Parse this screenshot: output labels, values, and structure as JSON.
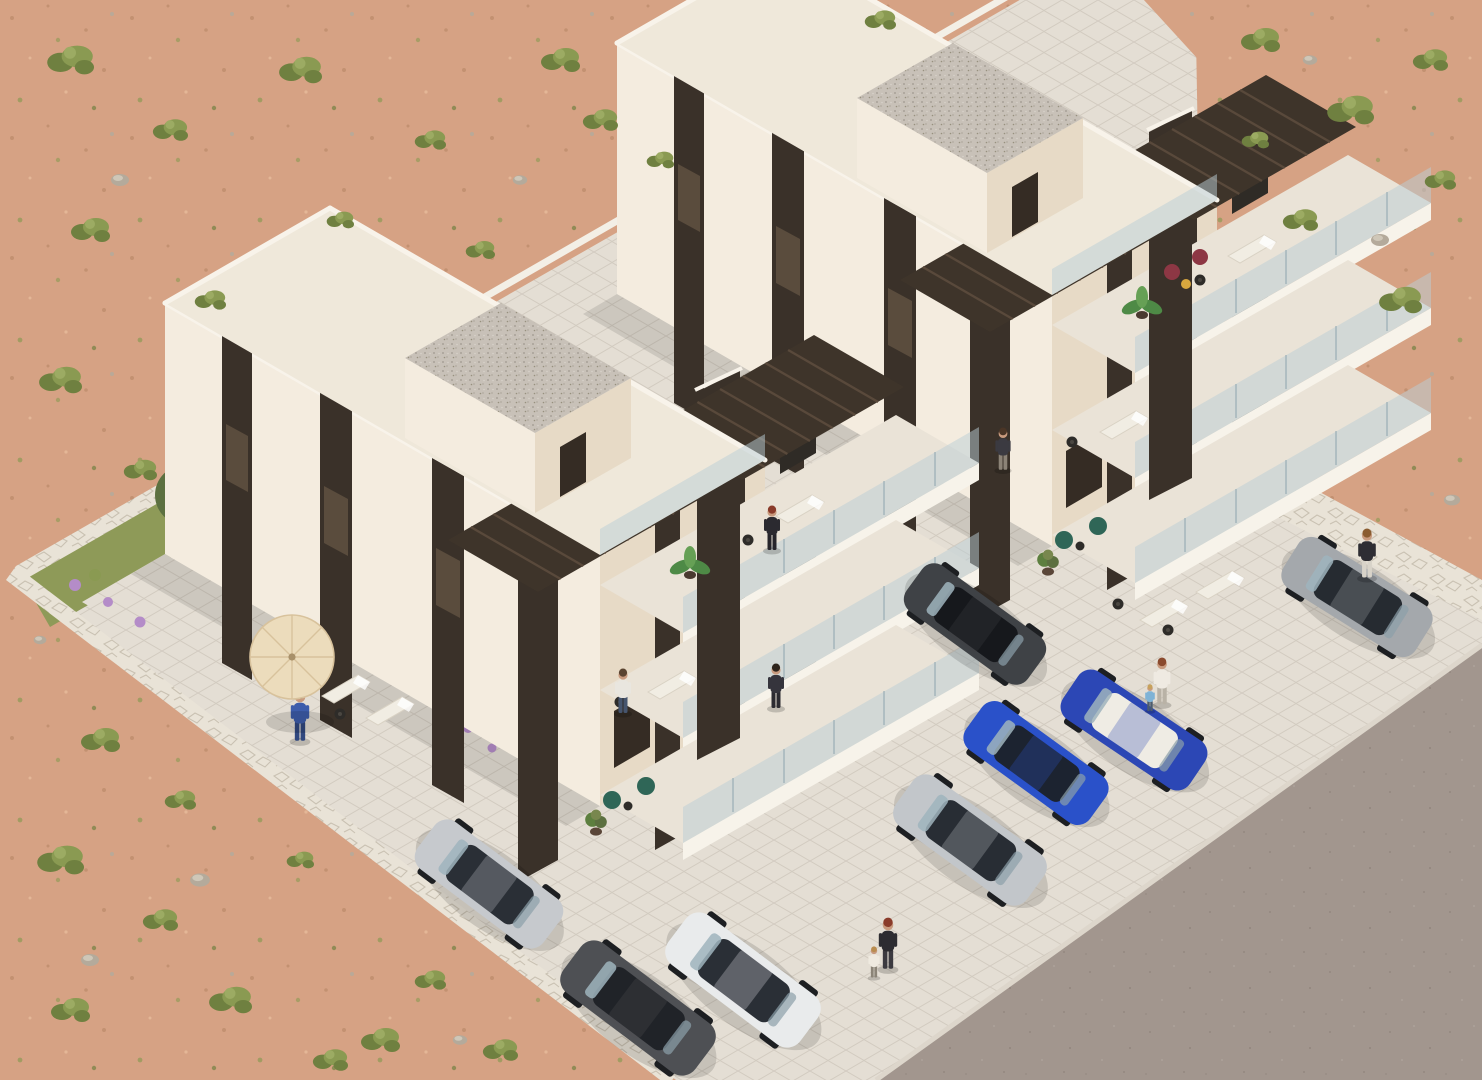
{
  "scene": {
    "description": "Aerial 3D architectural rendering of two modern cream apartment buildings with stepped balconies in desert scrubland, with parking lot, cars, people and an asphalt road at lower right",
    "setting": "desert scrubland with shrubs and rocks",
    "view": "isometric aerial",
    "building_count": 2,
    "car_count": 8,
    "people_count": 10
  },
  "palette": {
    "sand": "#d6a284",
    "sandDot": "#c08e6e",
    "sandLight": "#e6bb9a",
    "scrub1": "#8a9a52",
    "scrub2": "#6f8040",
    "scrub3": "#9cab63",
    "rock": "#b4aa9b",
    "pave": "#e4ded4",
    "paveLine": "#d2cbc0",
    "road": "#a2968e",
    "roadDot": "#948880",
    "curb": "#ddd6cb",
    "wallWhite": "#f3efe6",
    "stone": "#e9e3d7",
    "stoneLine": "#c9c1b2",
    "grass": "#8e9a58",
    "olive": "#5c7040",
    "oliveLight": "#78874e",
    "flower": "#b48cc8",
    "facade": "#f4ecdf",
    "facadeShade": "#e7dac6",
    "roofTop": "#efe8da",
    "parapet": "#f8f3ea",
    "strip": "#3a3129",
    "stripLight": "#5a4c3d",
    "slabTop": "#eae3d7",
    "slabFace": "#f7f3ea",
    "glass": "#b9cdd6",
    "glassPost": "#8fa6ae",
    "glassDoor": "#2f2b26",
    "pergola": "#3e342a",
    "pergolaSlat": "#59493b",
    "gravel": "#c8c1b8",
    "gravelDot": "#a9a198",
    "doorDark": "#352c24",
    "wheel": "#1d1f22",
    "umbrella": "#ecdcbc",
    "umbrellaRib": "#d8c29c",
    "skin": "#c89a7e",
    "chairGreen": "#2f6657",
    "chairRed": "#8d3744",
    "tableDark": "#2e2c29",
    "tableYellow": "#d9a73e",
    "plantGreen": "#5d7f3f",
    "palmGreen": "#4e8a46",
    "loungerWhite": "#f1ede3"
  },
  "buildings": [
    {
      "name": "apartment-building-left",
      "floors": 3,
      "features": [
        "stepped balconies",
        "glass railings",
        "dark window strips",
        "pergola roofs",
        "gravel roof tower",
        "umbrella terrace",
        "garage"
      ]
    },
    {
      "name": "apartment-building-right",
      "floors": 3,
      "features": [
        "stepped balconies",
        "glass railings",
        "dark window strips",
        "pergola roofs",
        "gravel roof tower",
        "red patio chairs",
        "garage"
      ]
    }
  ],
  "cars": [
    {
      "name": "silver-sedan-parked-left",
      "color": "#c6c9cd",
      "style": "--car-body:#c6c9cd;--car-glass:#2a2f36"
    },
    {
      "name": "dark-gray-suv",
      "color": "#4e5054",
      "style": "--car-body:#4e5054;--car-glass:#202328"
    },
    {
      "name": "white-suv",
      "color": "#e9ebec",
      "style": "--car-body:#e9ebec;--car-glass:#2a2f36"
    },
    {
      "name": "silver-sedan-center",
      "color": "#c2c6ca",
      "style": "--car-body:#c2c6ca;--car-glass:#282d34"
    },
    {
      "name": "blue-sedan",
      "color": "#2a51c9",
      "style": "--car-body:#2a51c9;--car-glass:#1c2330"
    },
    {
      "name": "blue-convertible-white-interior",
      "color": "#2c47b5",
      "style": "--car-body:#2c47b5;--car-glass:#efece4"
    },
    {
      "name": "black-sedan",
      "color": "#3f4246",
      "style": "--car-body:#3f4246;--car-glass:#16181c"
    },
    {
      "name": "gray-hatchback",
      "color": "#a4a8ac",
      "style": "--car-body:#a4a8ac;--car-glass:#262b31"
    }
  ],
  "people": [
    {
      "name": "man-blue-suit-umbrella-terrace",
      "style": "--p-top:#3d5cab;--p-bot:#31487f;--p-hair:#3a2e24"
    },
    {
      "name": "woman-black-dress-balcony",
      "style": "--p-top:#2b2a30;--p-bot:#26252b;--p-hair:#8a3b2a"
    },
    {
      "name": "woman-white-shirt-balcony",
      "style": "--p-top:#e9e6df;--p-bot:#46556e;--p-hair:#5a4330"
    },
    {
      "name": "man-dark-balcony",
      "style": "--p-top:#35343c;--p-bot:#2c2b31;--p-hair:#2e241c"
    },
    {
      "name": "woman-balcony-right-building",
      "style": "--p-top:#3b3a41;--p-bot:#8c8377;--p-hair:#4a3526"
    },
    {
      "name": "woman-walking-black-jacket",
      "style": "--p-top:#2d2c31;--p-bot:#3c3a40;--p-hair:#8a3b2a"
    },
    {
      "name": "child-walking-white",
      "style": "--p-top:#efeae0;--p-bot:#8b8477;--p-hair:#b98c4f"
    },
    {
      "name": "mother-white-top",
      "style": "--p-top:#efeae2;--p-bot:#b9b2a6;--p-hair:#8a4a2e"
    },
    {
      "name": "child-blue-top",
      "style": "--p-top:#7fb3d6;--p-bot:#4c5c6e;--p-hair:#c7a15c"
    },
    {
      "name": "woman-by-gray-car",
      "style": "--p-top:#2e2d33;--p-bot:#d8d3c9;--p-hair:#8a5c30"
    }
  ]
}
